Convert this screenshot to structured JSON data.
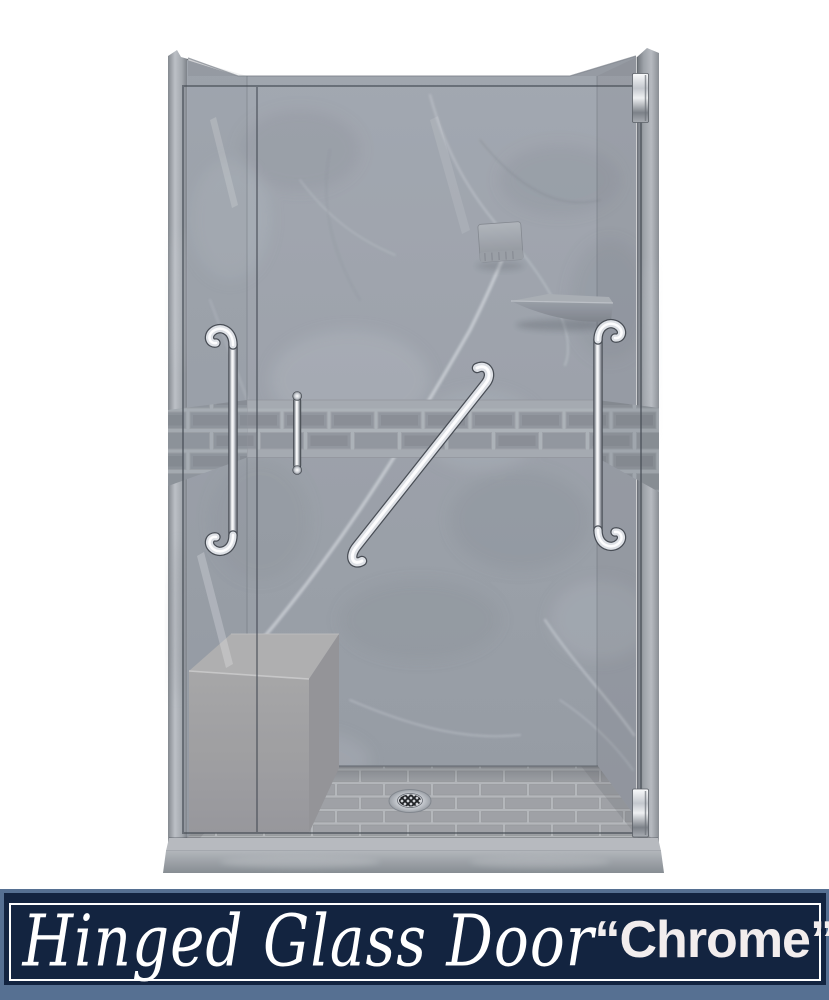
{
  "banner": {
    "title": "Hinged Glass Door",
    "finish": "“Chrome”",
    "background_color": "#132440",
    "frame_border_color": "#ffffff",
    "outer_trim_color": "#567092",
    "text_color": "#ffffff"
  },
  "colors": {
    "page_background": "#ffffff",
    "wall_marble": "#9aa0a8",
    "accent_tile": "#8f949b",
    "tile_mortar": "#aab0b6",
    "bench_gray": "#9c9c9c",
    "chrome_highlight": "#ffffff",
    "chrome_shadow": "#4e535a",
    "glass_line": "#454b53"
  }
}
